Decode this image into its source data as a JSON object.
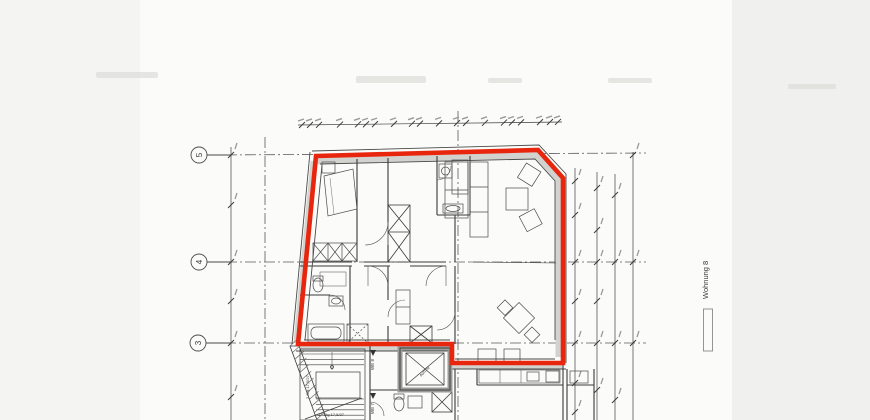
{
  "plan": {
    "apartment_label": "Wohnung 8",
    "elevator_label": "Aufzug",
    "unit_marker_top": "WE 8",
    "unit_marker_bottom": "WE 7",
    "stair_note_left": "2 Stg 17,5/27",
    "stair_note_bottom": "17 Stg 17,5/27",
    "grid_rows": [
      {
        "label": "5"
      },
      {
        "label": "4"
      },
      {
        "label": "3"
      }
    ],
    "colors": {
      "outline_red": "#e8260e",
      "ink": "#3a3a3a",
      "paper": "#fbfbf9"
    }
  }
}
